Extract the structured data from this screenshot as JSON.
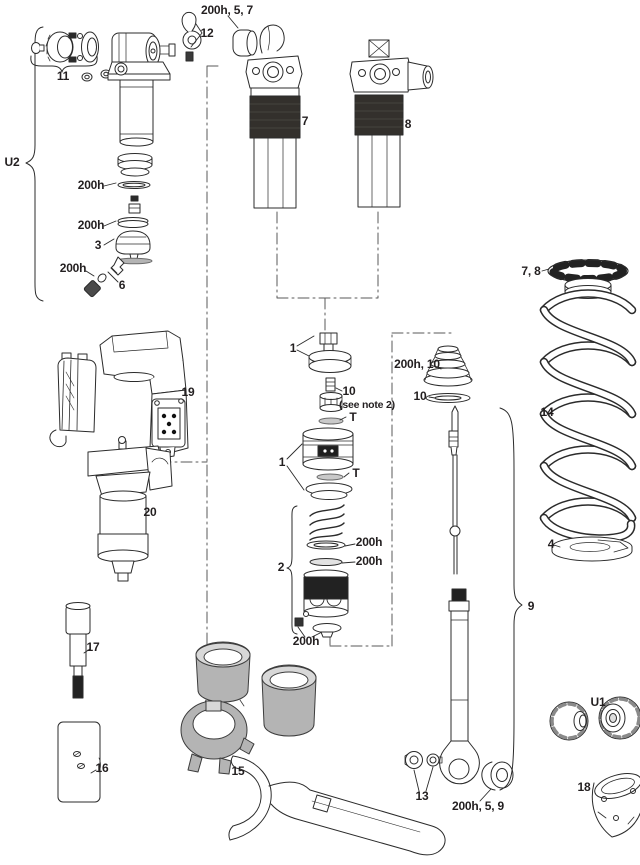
{
  "diagram": {
    "type": "exploded-parts-diagram",
    "subject": "rear shock exploded parts view",
    "colors": {
      "background": "#ffffff",
      "line": "#2b2b2b",
      "dark_band": "#33302c",
      "gray_part": "#b4b4b4"
    },
    "labels": {
      "bumper_top": "200h, 5, 7",
      "lever": "12",
      "knob_group": "11",
      "u2": "U2",
      "aircan_ring1": "200h",
      "aircan_ring2": "200h",
      "aircan_piston": "3",
      "valve_oring": "200h",
      "valve_core6": "6",
      "shock7": "7",
      "shock8": "8",
      "valve_cap1": "1",
      "core10": "10",
      "core10_note": "(see note 2)",
      "t_upper": "T",
      "piston1": "1",
      "t_lower": "T",
      "bellows": "200h, 10",
      "washer10": "10",
      "group2": "2",
      "washer2a": "200h",
      "washer2b": "200h",
      "group2_bottom": "200h",
      "module19": "19",
      "module20": "20",
      "tool17": "17",
      "block16": "16",
      "ringset15": "15",
      "nuts13": "13",
      "bushing": "200h, 5, 9",
      "damper9": "9",
      "ring78": "7, 8",
      "spring14": "14",
      "clip4": "4",
      "u1": "U1",
      "drum18": "18"
    }
  }
}
